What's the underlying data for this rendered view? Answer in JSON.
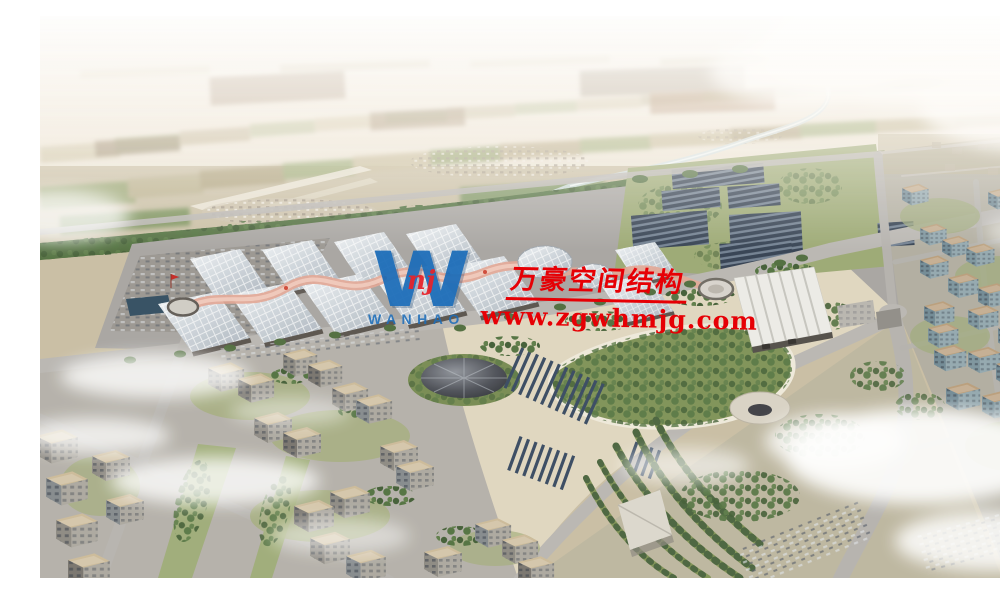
{
  "meta": {
    "description": "Hazy aerial architectural rendering of a large exhibition-center masterplan: rows of vaulted gridshell halls with pink ridge canopies, a pleated white hall, a greenhouse/solar field, a landscaped park with funnel-shaped pavilions and terraced tree arcs, surrounded by mid-rise city blocks and farmland stretching to the horizon"
  },
  "watermark": {
    "company_name_zh": "万豪空间结构",
    "website": "www.zgwhmjg.com",
    "logo": {
      "letter": "W",
      "monogram": "nj",
      "wordmark": "WANHAO"
    }
  },
  "palette": {
    "watermark_red": "#e60005",
    "logo_blue": "#1d6db8",
    "logo_red": "#e5242b",
    "sky_haze": "#f2ede7",
    "farmland_tan": "#c3b692",
    "farmland_green": "#93a46b",
    "vegetation_dark": "#4c6a3a",
    "hall_roof_silver": "#d9dee3",
    "hall_ridge_pink": "#e2a492",
    "solar_panel_dark": "#2f3c4e",
    "road_gray": "#b8b5b1",
    "plaza_tan": "#e0d6bf",
    "water_blue": "#2e4a5e",
    "cloud_white": "#ffffff"
  }
}
